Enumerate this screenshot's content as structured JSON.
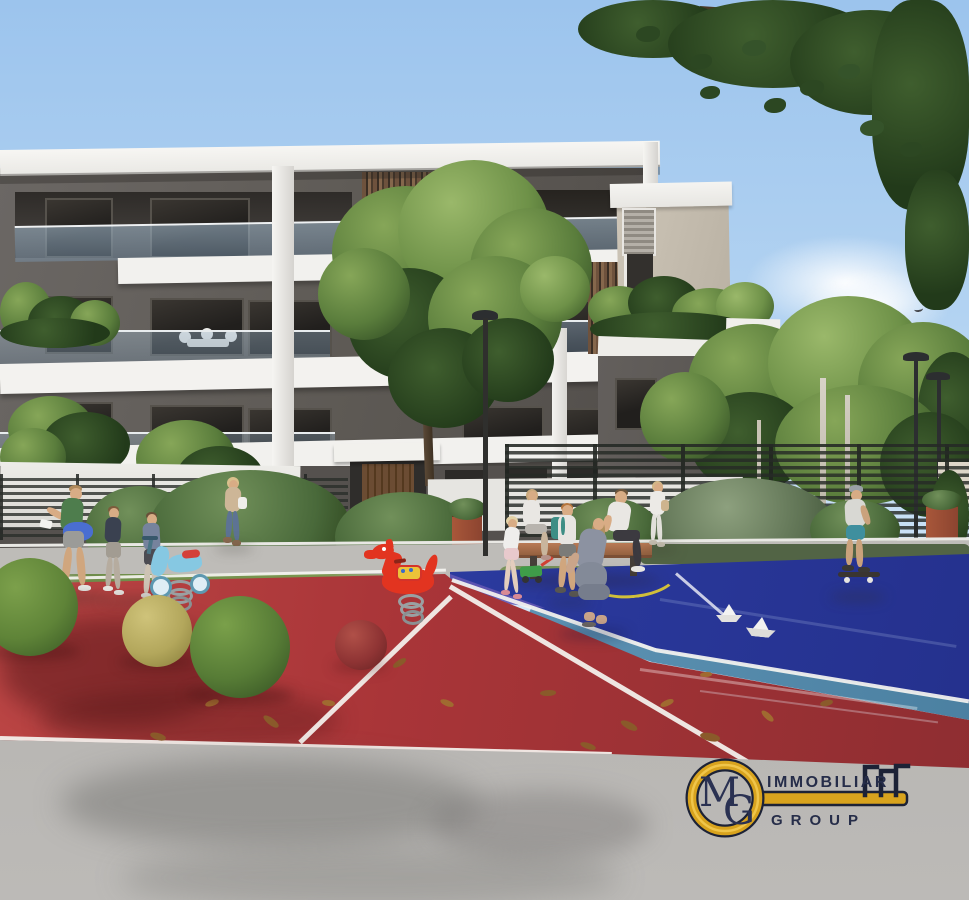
{
  "watermark": {
    "icon": "key-icon",
    "monogram_m": "M",
    "monogram_g": "G",
    "line1": "IMMOBILIAR",
    "line2": "GROUP"
  },
  "colors": {
    "sky_top": "#9cc4ed",
    "sky_bottom": "#dcebf8",
    "roof_white": "#f4f3f0",
    "facade_dark": "#5d5954",
    "facade_recess": "#35322e",
    "facade_beige": "#c8c0b2",
    "wood_slats": "#7a5d45",
    "balcony_glass": "#adc3d4",
    "tree_green": "#5a7d3c",
    "tree_dark": "#2c4722",
    "bush_green": "#49693a",
    "red_surface": "#a93538",
    "violet_patch": "#6157b2",
    "blue_court": "#2b3a9e",
    "teal_band": "#5d93b4",
    "yellow_line": "#d3c23c",
    "walkway": "#c6c4c0",
    "pavement": "#bcbab7",
    "fence_metal": "#2a2e2a",
    "corten_planter": "#9e5238",
    "sphere_green": "#5f8438",
    "sphere_olive": "#b3a75c",
    "sphere_red": "#8f3434",
    "bench_wood": "#a5684a",
    "spring_rider_red": "#e23420",
    "spring_rider_blue": "#86c8e2",
    "logo_gold": "#d8a31e",
    "logo_outline": "#1c2236",
    "logo_text": "#262d49"
  }
}
